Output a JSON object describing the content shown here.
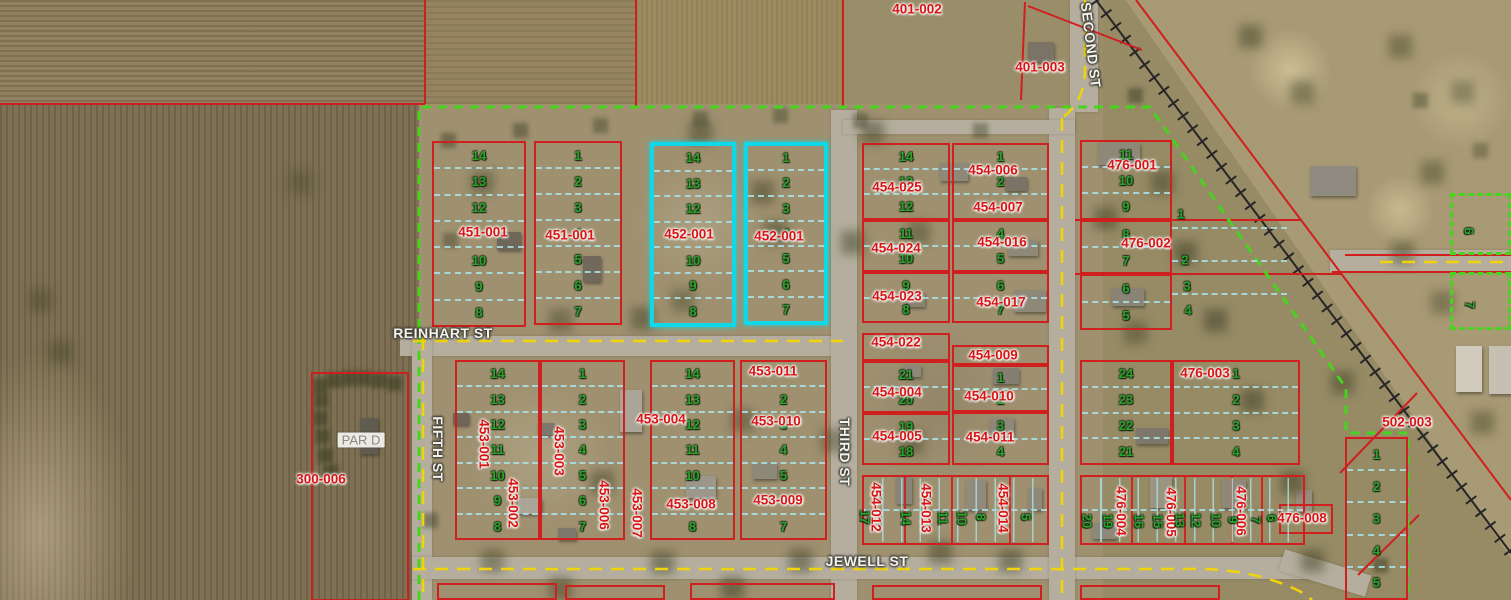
{
  "map": {
    "highlight_color": "#10d8e6",
    "parcel_line_color": "#cf1f1f",
    "lot_number_color": "#2ba32b",
    "subdivision_boundary_color": "#46d41c",
    "road_centerline_color": "#f0d408"
  },
  "street_labels": [
    {
      "t": "REINHART ST",
      "x": 443,
      "y": 333,
      "rot": 0
    },
    {
      "t": "JEWELL ST",
      "x": 867,
      "y": 561,
      "rot": 0
    },
    {
      "t": "FIFTH ST",
      "x": 438,
      "y": 449,
      "rot": 90
    },
    {
      "t": "THIRD ST",
      "x": 845,
      "y": 452,
      "rot": 90
    },
    {
      "t": "SECOND ST",
      "x": 1091,
      "y": 45,
      "rot": 83
    }
  ],
  "area_labels": [
    {
      "t": "PAR D",
      "x": 361,
      "y": 440
    }
  ],
  "parcel_labels": [
    {
      "t": "401-002",
      "x": 917,
      "y": 9
    },
    {
      "t": "401-003",
      "x": 1040,
      "y": 67
    },
    {
      "t": "451-001",
      "x": 483,
      "y": 232
    },
    {
      "t": "451-001",
      "x": 570,
      "y": 235
    },
    {
      "t": "452-001",
      "x": 689,
      "y": 234
    },
    {
      "t": "452-001",
      "x": 779,
      "y": 236
    },
    {
      "t": "454-025",
      "x": 897,
      "y": 187
    },
    {
      "t": "454-024",
      "x": 896,
      "y": 248
    },
    {
      "t": "454-023",
      "x": 897,
      "y": 296
    },
    {
      "t": "454-006",
      "x": 993,
      "y": 170
    },
    {
      "t": "454-007",
      "x": 998,
      "y": 207
    },
    {
      "t": "454-016",
      "x": 1002,
      "y": 242
    },
    {
      "t": "454-017",
      "x": 1001,
      "y": 302
    },
    {
      "t": "454-022",
      "x": 896,
      "y": 342
    },
    {
      "t": "454-009",
      "x": 993,
      "y": 355
    },
    {
      "t": "454-004",
      "x": 897,
      "y": 392
    },
    {
      "t": "454-010",
      "x": 989,
      "y": 396
    },
    {
      "t": "454-005",
      "x": 897,
      "y": 436
    },
    {
      "t": "454-011",
      "x": 990,
      "y": 437
    },
    {
      "t": "476-001",
      "x": 1132,
      "y": 165
    },
    {
      "t": "476-002",
      "x": 1146,
      "y": 243
    },
    {
      "t": "476-003",
      "x": 1205,
      "y": 373
    },
    {
      "t": "502-003",
      "x": 1407,
      "y": 422
    },
    {
      "t": "300-006",
      "x": 321,
      "y": 479
    },
    {
      "t": "453-011",
      "x": 773,
      "y": 371
    },
    {
      "t": "453-004",
      "x": 661,
      "y": 419
    },
    {
      "t": "453-010",
      "x": 776,
      "y": 421
    },
    {
      "t": "453-008",
      "x": 691,
      "y": 504
    },
    {
      "t": "453-009",
      "x": 778,
      "y": 500
    },
    {
      "t": "476-008",
      "x": 1302,
      "y": 518
    },
    {
      "t": "453-001",
      "x": 484,
      "y": 444,
      "v": 1
    },
    {
      "t": "453-003",
      "x": 559,
      "y": 451,
      "v": 1
    },
    {
      "t": "453-002",
      "x": 513,
      "y": 503,
      "v": 1
    },
    {
      "t": "453-006",
      "x": 604,
      "y": 505,
      "v": 1
    },
    {
      "t": "453-007",
      "x": 637,
      "y": 513,
      "v": 1
    },
    {
      "t": "454-012",
      "x": 876,
      "y": 507,
      "v": 1
    },
    {
      "t": "454-013",
      "x": 926,
      "y": 508,
      "v": 1
    },
    {
      "t": "454-014",
      "x": 1003,
      "y": 508,
      "v": 1
    },
    {
      "t": "476-004",
      "x": 1121,
      "y": 511,
      "v": 1
    },
    {
      "t": "476-005",
      "x": 1171,
      "y": 512,
      "v": 1
    },
    {
      "t": "476-006",
      "x": 1241,
      "y": 511,
      "v": 1
    }
  ],
  "lot_labels": [
    {
      "t": "17",
      "x": 865,
      "y": 517,
      "v": 1
    },
    {
      "t": "14",
      "x": 906,
      "y": 518,
      "v": 1
    },
    {
      "t": "11",
      "x": 943,
      "y": 518,
      "v": 1
    },
    {
      "t": "10",
      "x": 962,
      "y": 518,
      "v": 1
    },
    {
      "t": "8",
      "x": 981,
      "y": 517,
      "v": 1
    },
    {
      "t": "5",
      "x": 1026,
      "y": 517,
      "v": 1
    },
    {
      "t": "20",
      "x": 1087,
      "y": 521,
      "v": 1
    },
    {
      "t": "19",
      "x": 1108,
      "y": 521,
      "v": 1
    },
    {
      "t": "16",
      "x": 1139,
      "y": 521,
      "v": 1
    },
    {
      "t": "15",
      "x": 1158,
      "y": 521,
      "v": 1
    },
    {
      "t": "13",
      "x": 1180,
      "y": 520,
      "v": 1
    },
    {
      "t": "12",
      "x": 1196,
      "y": 520,
      "v": 1
    },
    {
      "t": "10",
      "x": 1216,
      "y": 520,
      "v": 1
    },
    {
      "t": "9",
      "x": 1233,
      "y": 520,
      "v": 1
    },
    {
      "t": "7",
      "x": 1256,
      "y": 520,
      "v": 1
    },
    {
      "t": "6",
      "x": 1272,
      "y": 518,
      "v": 1
    },
    {
      "t": "6",
      "x": 1469,
      "y": 231,
      "v": 1
    },
    {
      "t": "7",
      "x": 1470,
      "y": 305,
      "v": 1
    },
    {
      "t": "1",
      "x": 1181,
      "y": 214,
      "v": 0
    },
    {
      "t": "2",
      "x": 1185,
      "y": 260,
      "v": 0
    },
    {
      "t": "3",
      "x": 1187,
      "y": 286,
      "v": 0
    },
    {
      "t": "4",
      "x": 1188,
      "y": 310,
      "v": 0
    }
  ],
  "blocks": [
    {
      "x": 432,
      "y": 141,
      "w": 94,
      "h": 186,
      "b": "red",
      "rows": [
        "14",
        "13",
        "12",
        "",
        "10",
        "9",
        "8"
      ]
    },
    {
      "x": 534,
      "y": 141,
      "w": 88,
      "h": 184,
      "b": "red",
      "rows": [
        "1",
        "2",
        "3",
        "4",
        "5",
        "6",
        "7"
      ]
    },
    {
      "x": 650,
      "y": 142,
      "w": 86,
      "h": 185,
      "b": "cyan",
      "rows": [
        "14",
        "13",
        "12",
        "",
        "10",
        "9",
        "8"
      ]
    },
    {
      "x": 744,
      "y": 142,
      "w": 84,
      "h": 183,
      "b": "cyan",
      "rows": [
        "1",
        "2",
        "3",
        "4",
        "5",
        "6",
        "7"
      ]
    },
    {
      "x": 862,
      "y": 143,
      "w": 88,
      "h": 77,
      "b": "red",
      "rows": [
        "14",
        "13",
        "12"
      ]
    },
    {
      "x": 862,
      "y": 220,
      "w": 88,
      "h": 52,
      "b": "red",
      "rows": [
        "11",
        "10"
      ]
    },
    {
      "x": 862,
      "y": 272,
      "w": 88,
      "h": 51,
      "b": "red",
      "rows": [
        "9",
        "8"
      ]
    },
    {
      "x": 952,
      "y": 143,
      "w": 97,
      "h": 77,
      "b": "red",
      "rows": [
        "1",
        "2",
        ""
      ]
    },
    {
      "x": 952,
      "y": 220,
      "w": 97,
      "h": 52,
      "b": "red",
      "rows": [
        "4",
        "5"
      ]
    },
    {
      "x": 952,
      "y": 272,
      "w": 97,
      "h": 51,
      "b": "red",
      "rows": [
        "6",
        "7"
      ]
    },
    {
      "x": 862,
      "y": 333,
      "w": 88,
      "h": 28,
      "b": "red",
      "rows": []
    },
    {
      "x": 862,
      "y": 361,
      "w": 88,
      "h": 52,
      "b": "red",
      "rows": [
        "21",
        "20"
      ]
    },
    {
      "x": 862,
      "y": 413,
      "w": 88,
      "h": 52,
      "b": "red",
      "rows": [
        "19",
        "18"
      ]
    },
    {
      "x": 952,
      "y": 345,
      "w": 97,
      "h": 20,
      "b": "red",
      "rows": []
    },
    {
      "x": 952,
      "y": 365,
      "w": 97,
      "h": 47,
      "b": "red",
      "rows": [
        "1",
        "2"
      ]
    },
    {
      "x": 952,
      "y": 412,
      "w": 97,
      "h": 53,
      "b": "red",
      "rows": [
        "3",
        "4"
      ]
    },
    {
      "x": 455,
      "y": 360,
      "w": 85,
      "h": 180,
      "b": "red",
      "rows": [
        "14",
        "13",
        "12",
        "11",
        "10",
        "9",
        "8"
      ]
    },
    {
      "x": 540,
      "y": 360,
      "w": 85,
      "h": 180,
      "b": "red",
      "rows": [
        "1",
        "2",
        "3",
        "4",
        "5",
        "6",
        "7"
      ]
    },
    {
      "x": 650,
      "y": 360,
      "w": 85,
      "h": 180,
      "b": "red",
      "rows": [
        "14",
        "13",
        "12",
        "11",
        "10",
        "",
        "8"
      ]
    },
    {
      "x": 740,
      "y": 360,
      "w": 87,
      "h": 180,
      "b": "red",
      "rows": [
        "",
        "2",
        "3",
        "4",
        "5",
        "",
        "7"
      ]
    },
    {
      "x": 1080,
      "y": 140,
      "w": 92,
      "h": 80,
      "b": "red",
      "rows": [
        "11",
        "10",
        "9"
      ]
    },
    {
      "x": 1080,
      "y": 220,
      "w": 92,
      "h": 54,
      "b": "red",
      "rows": [
        "8",
        "7"
      ]
    },
    {
      "x": 1080,
      "y": 274,
      "w": 92,
      "h": 56,
      "b": "red",
      "rows": [
        "6",
        "5"
      ]
    },
    {
      "x": 1172,
      "y": 196,
      "w": 115,
      "h": 130,
      "b": "none",
      "rows": [
        "",
        "",
        "",
        ""
      ]
    },
    {
      "x": 1080,
      "y": 360,
      "w": 92,
      "h": 105,
      "b": "red",
      "rows": [
        "24",
        "23",
        "22",
        "21"
      ]
    },
    {
      "x": 1172,
      "y": 360,
      "w": 128,
      "h": 105,
      "b": "red",
      "rows": [
        "1",
        "2",
        "3",
        "4"
      ]
    },
    {
      "x": 862,
      "y": 475,
      "w": 187,
      "h": 70,
      "b": "red",
      "rows": [
        "",
        ""
      ],
      "cols": 10
    },
    {
      "x": 1080,
      "y": 475,
      "w": 225,
      "h": 70,
      "b": "red",
      "rows": [
        "",
        ""
      ],
      "cols": 12
    },
    {
      "x": 1345,
      "y": 437,
      "w": 63,
      "h": 163,
      "b": "red",
      "rows": [
        "1",
        "2",
        "3",
        "4",
        "5"
      ]
    },
    {
      "x": 1450,
      "y": 193,
      "w": 61,
      "h": 62,
      "b": "green",
      "rows": []
    },
    {
      "x": 1450,
      "y": 272,
      "w": 61,
      "h": 58,
      "b": "green",
      "rows": []
    },
    {
      "x": 437,
      "y": 583,
      "w": 120,
      "h": 17,
      "b": "red",
      "rows": []
    },
    {
      "x": 565,
      "y": 585,
      "w": 100,
      "h": 15,
      "b": "red",
      "rows": []
    },
    {
      "x": 690,
      "y": 583,
      "w": 145,
      "h": 17,
      "b": "red",
      "rows": []
    },
    {
      "x": 872,
      "y": 585,
      "w": 170,
      "h": 15,
      "b": "red",
      "rows": []
    },
    {
      "x": 1080,
      "y": 585,
      "w": 140,
      "h": 15,
      "b": "red",
      "rows": []
    }
  ]
}
